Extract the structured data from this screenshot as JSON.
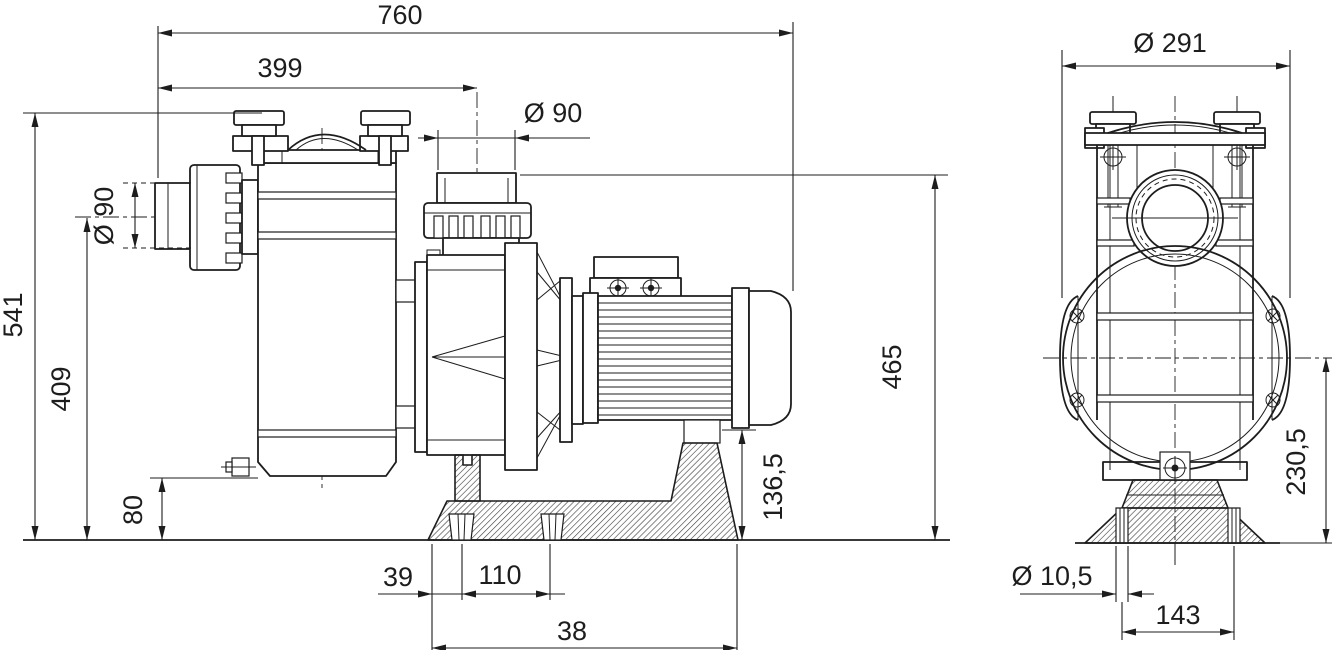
{
  "dimensions": {
    "side": {
      "overall_length": "760",
      "inlet_to_outlet_length": "399",
      "outlet_diameter": "Ø 90",
      "inlet_diameter": "Ø 90",
      "total_height": "541",
      "inlet_axis_height": "409",
      "drain_height": "80",
      "outlet_top_height": "465",
      "motor_foot_height": "136,5",
      "base_edge_to_slot": "39",
      "slot_spacing": "110",
      "base_length": "38"
    },
    "front": {
      "lid_diameter": "Ø 291",
      "axis_to_base_height": "230,5",
      "foot_hole_diameter": "Ø 10,5",
      "foot_hole_spacing": "143"
    }
  }
}
